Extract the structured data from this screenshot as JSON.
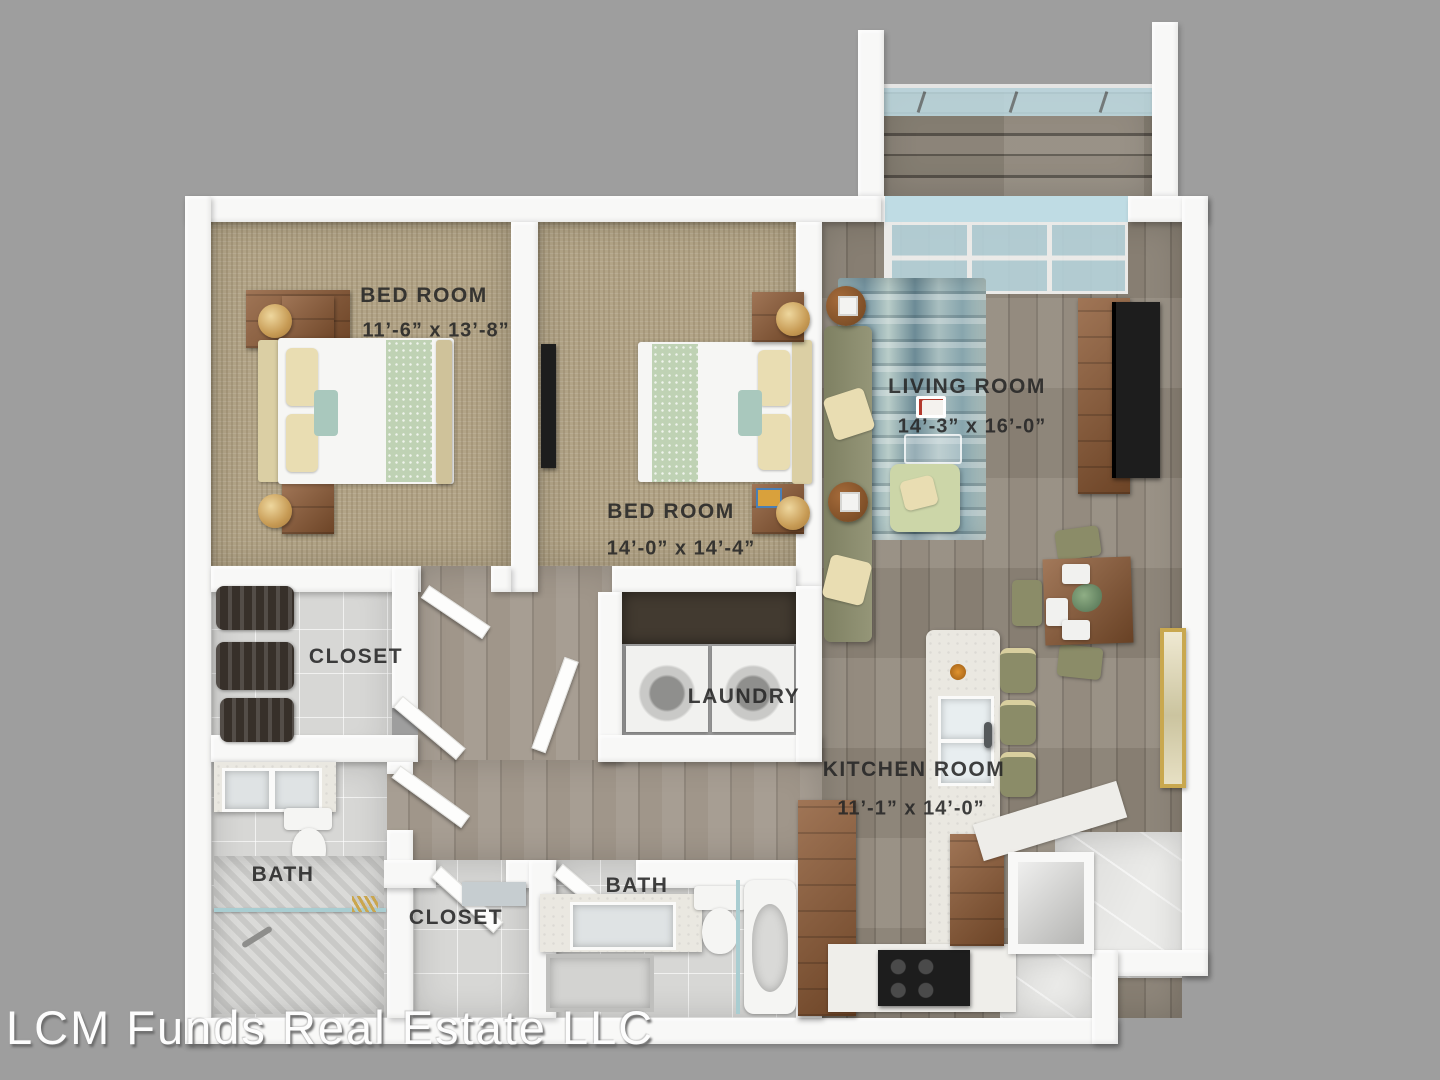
{
  "watermark": "LCM Funds Real Estate LLC",
  "rooms": {
    "bedroom1": {
      "name": "BED ROOM",
      "dims": "11’-6” x 13’-8”"
    },
    "bedroom2": {
      "name": "BED ROOM",
      "dims": "14’-0” x 14’-4”"
    },
    "living_room": {
      "name": "LIVING ROOM",
      "dims": "14’-3” x 16’-0”"
    },
    "kitchen": {
      "name": "KITCHEN ROOM",
      "dims": "11’-1” x 14’-0”"
    },
    "closet_upper": {
      "name": "CLOSET"
    },
    "laundry": {
      "name": "LAUNDRY"
    },
    "bath_left": {
      "name": "BATH"
    },
    "closet_lower": {
      "name": "CLOSET"
    },
    "bath_lower": {
      "name": "BATH"
    }
  },
  "colors": {
    "background": "#9e9e9e",
    "wall": "#f8f8f7",
    "carpet": "#b2a487",
    "wood_floor": "#8e8578",
    "tile": "#d7d7d5",
    "glass": "#bfdce4",
    "furniture_wood": "#8b5731",
    "olive": "#8b8c68",
    "label_text": "#262626",
    "watermark_text": "#fdfdfd"
  }
}
